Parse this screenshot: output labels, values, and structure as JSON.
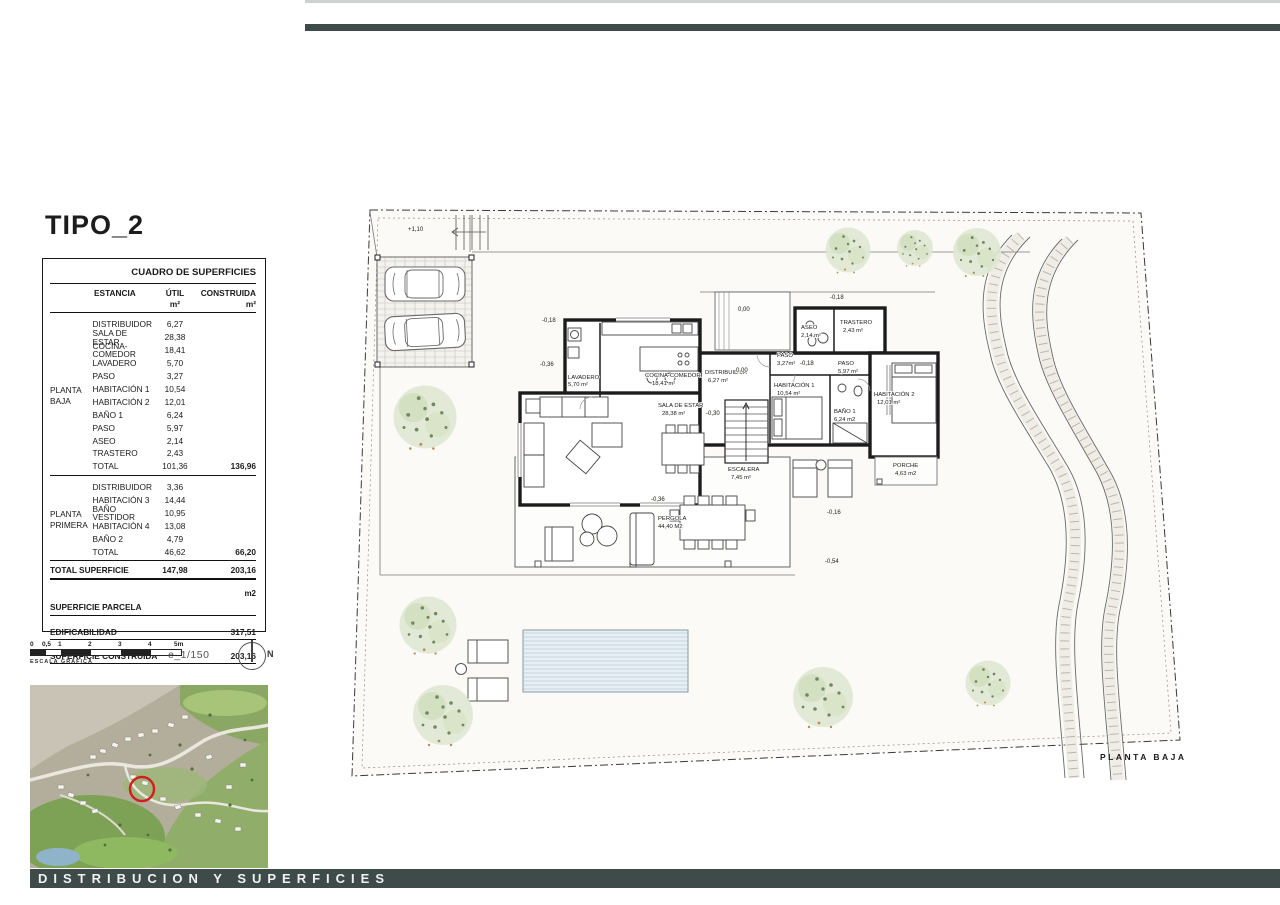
{
  "title": "TIPO_2",
  "colors": {
    "bar": "#3e4b49",
    "marker_red": "#cf1f1f",
    "pool_fill": "#e7eff4",
    "tree_green": "#dfe8d3"
  },
  "table": {
    "header": "CUADRO DE SUPERFICIES",
    "col_estancia": "ESTANCIA",
    "col_util": "ÚTIL",
    "col_construida": "CONSTRUIDA",
    "unit_util": "m²",
    "unit_construida": "m²",
    "groups": [
      {
        "label_line1": "PLANTA",
        "label_line2": "BAJA",
        "rows": [
          {
            "name": "DISTRIBUIDOR",
            "util": "6,27",
            "construida": ""
          },
          {
            "name": "SALA DE ESTAR",
            "util": "28,38",
            "construida": ""
          },
          {
            "name": "COCINA-COMEDOR",
            "util": "18,41",
            "construida": ""
          },
          {
            "name": "LAVADERO",
            "util": "5,70",
            "construida": ""
          },
          {
            "name": "PASO",
            "util": "3,27",
            "construida": ""
          },
          {
            "name": "HABITACIÓN 1",
            "util": "10,54",
            "construida": ""
          },
          {
            "name": "HABITACIÓN 2",
            "util": "12,01",
            "construida": ""
          },
          {
            "name": "BAÑO 1",
            "util": "6,24",
            "construida": ""
          },
          {
            "name": "PASO",
            "util": "5,97",
            "construida": ""
          },
          {
            "name": "ASEO",
            "util": "2,14",
            "construida": ""
          },
          {
            "name": "TRASTERO",
            "util": "2,43",
            "construida": ""
          }
        ],
        "total": {
          "name": "TOTAL",
          "util": "101,36",
          "construida": "136,96"
        }
      },
      {
        "label_line1": "PLANTA",
        "label_line2": "PRIMERA",
        "rows": [
          {
            "name": "DISTRIBUIDOR",
            "util": "3,36",
            "construida": ""
          },
          {
            "name": "HABITACIÓN 3",
            "util": "14,44",
            "construida": ""
          },
          {
            "name": "BAÑO VESTIDOR",
            "util": "10,95",
            "construida": ""
          },
          {
            "name": "HABITACIÓN 4",
            "util": "13,08",
            "construida": ""
          },
          {
            "name": "BAÑO 2",
            "util": "4,79",
            "construida": ""
          }
        ],
        "total": {
          "name": "TOTAL",
          "util": "46,62",
          "construida": "66,20"
        }
      }
    ],
    "total_superficie": {
      "name": "TOTAL SUPERFICIE",
      "util": "147,98",
      "construida": "203,16"
    },
    "m2_label": "m2",
    "footer_rows": [
      {
        "label": "SUPERFICIE PARCELA",
        "value": ""
      },
      {
        "label": "EDIFICABILIDAD",
        "value": "317,51"
      },
      {
        "label": "SUPERFICIE CONSTRUIDA",
        "value": "203,16"
      }
    ]
  },
  "scale": {
    "ticks": [
      "0",
      "0,5",
      "1",
      "2",
      "3",
      "4",
      "5m"
    ],
    "caption": "ESCALA GRAFICA",
    "ratio": "e_1/150",
    "north": "N"
  },
  "plan": {
    "caption": "PLANTA  BAJA",
    "rooms": [
      {
        "name": "LAVADERO",
        "area": "5,70  m²"
      },
      {
        "name": "COCINA-COMEDOR",
        "area": "18,41  m²"
      },
      {
        "name": "SALA  DE  ESTAR",
        "area": "28,38  m²"
      },
      {
        "name": "DISTRIBUIDOR",
        "area": "6,27 m²"
      },
      {
        "name": "ESCALERA",
        "area": "7,45 m²"
      },
      {
        "name": "PASO",
        "area": "3,27m²"
      },
      {
        "name": "ASEO",
        "area": "2,14  m²"
      },
      {
        "name": "TRASTERO",
        "area": "2,43  m²"
      },
      {
        "name": "PASO",
        "area": "5,97  m²"
      },
      {
        "name": "HABITACIÓN 1",
        "area": "10,54 m²"
      },
      {
        "name": "BAÑO 1",
        "area": "6,24  m2"
      },
      {
        "name": "HABITACIÓN 2",
        "area": "12,01 m²"
      },
      {
        "name": "PORCHE",
        "area": "4,63  m2"
      },
      {
        "name": "PERGOLA",
        "area": "44,40  M2"
      }
    ],
    "levels": [
      {
        "t": "+1,10"
      },
      {
        "t": "0,00"
      },
      {
        "t": "-0,18"
      },
      {
        "t": "-0,18"
      },
      {
        "t": "-0,36"
      },
      {
        "t": "0,00"
      },
      {
        "t": "-0,30"
      },
      {
        "t": "-0,18"
      },
      {
        "t": "-0,36"
      },
      {
        "t": "-0,16"
      },
      {
        "t": "-0,54"
      }
    ]
  },
  "footer": {
    "label": "DISTRIBUCION Y SUPERFICIES"
  }
}
